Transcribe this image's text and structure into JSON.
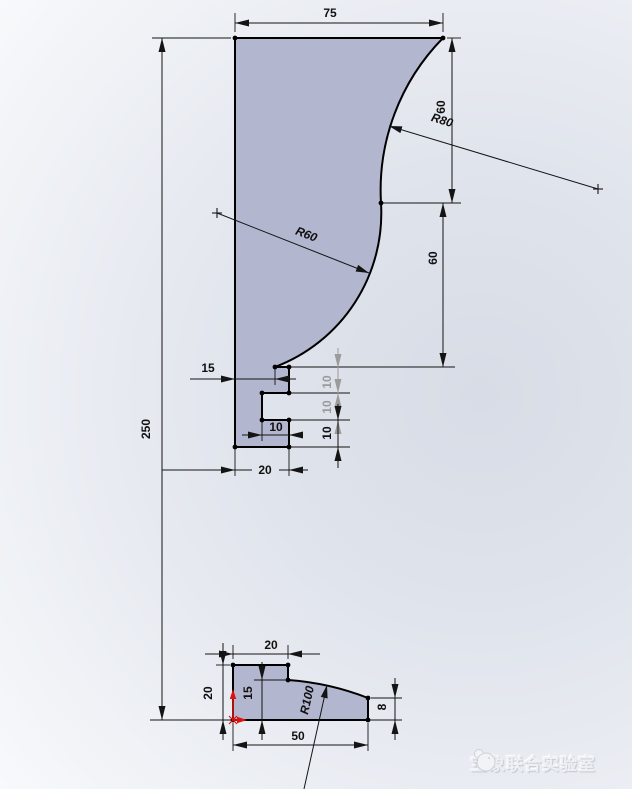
{
  "drawing": {
    "upper_sketch": {
      "dims": {
        "width_top": "75",
        "total_height": "250",
        "right_drop_upper": "60",
        "right_drop_lower": "60",
        "radius_upper": "R80",
        "radius_lower": "R60",
        "step_offset": "15",
        "notch_width": "10",
        "base_width": "20",
        "step_height_1": "10",
        "step_height_2": "10",
        "step_height_3": "10"
      }
    },
    "lower_sketch": {
      "dims": {
        "top_width": "20",
        "left_height": "20",
        "mid_height": "15",
        "right_height": "8",
        "base_width": "50",
        "radius": "R100"
      }
    }
  },
  "colors": {
    "profile_fill": "#b3b6cf",
    "sketch_line": "#000000",
    "driven_dim_gray": "#9b9b9b",
    "origin_red": "#dd1111"
  },
  "watermark": {
    "icon": "elephant-logo",
    "text": "宝象联合实验室"
  }
}
